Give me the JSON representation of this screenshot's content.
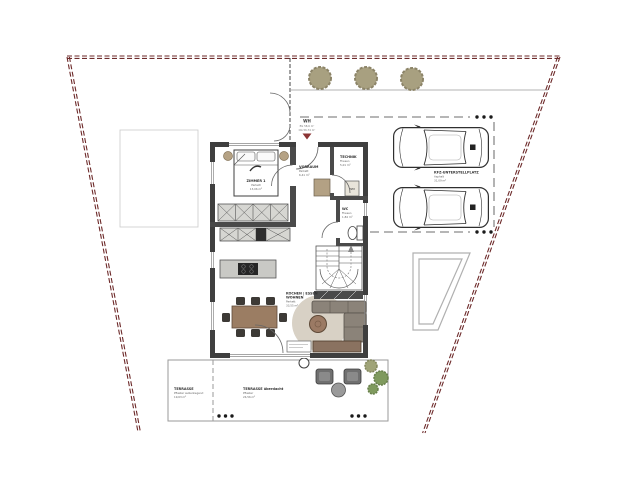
{
  "plan": {
    "house_marker": {
      "title": "WH",
      "line1": "EG 58,6 m²",
      "line2": "OG 56,74 m²"
    },
    "rooms": {
      "zimmer1": {
        "name": "ZIMMER 1",
        "floor": "Parkett",
        "area": "13,06 m²"
      },
      "vorraum": {
        "name": "VORRAUM",
        "floor": "Parkett",
        "area": "6,41 m²"
      },
      "technik": {
        "name": "TECHNIK",
        "floor": "Fliesen",
        "area": "5,01 m²"
      },
      "wc": {
        "name": "WC",
        "floor": "Fliesen",
        "area": "1,84 m²"
      },
      "wohnen": {
        "name": "KOCHEN | ESSEN",
        "name2": "WOHNEN",
        "floor": "Parkett",
        "area": "33,55 m²"
      },
      "terrasse": {
        "name": "TERRASSE",
        "floor": "Pflaster außenliegend",
        "area": "19,63 m²"
      },
      "terrasse_ueberdacht": {
        "name": "TERRASSE überdacht",
        "floor": "Pflaster",
        "area": "24,56 m²"
      },
      "carport": {
        "name": "KFZ-UNTERSTELLPLATZ",
        "floor": "Asphalt",
        "area": "31,09 m²"
      }
    },
    "appliances": {
      "wm": "WM"
    },
    "colors": {
      "boundary": "#6d2a2a",
      "wall": "#3f3f3f",
      "marker": "#8b3434",
      "wood": "#9b7d63",
      "rug": "#d8d1c5",
      "couch": "#8b8379",
      "tree": "#a8a080",
      "bush": "#7f9a5e",
      "cabinet": "#d6d6d2"
    }
  }
}
